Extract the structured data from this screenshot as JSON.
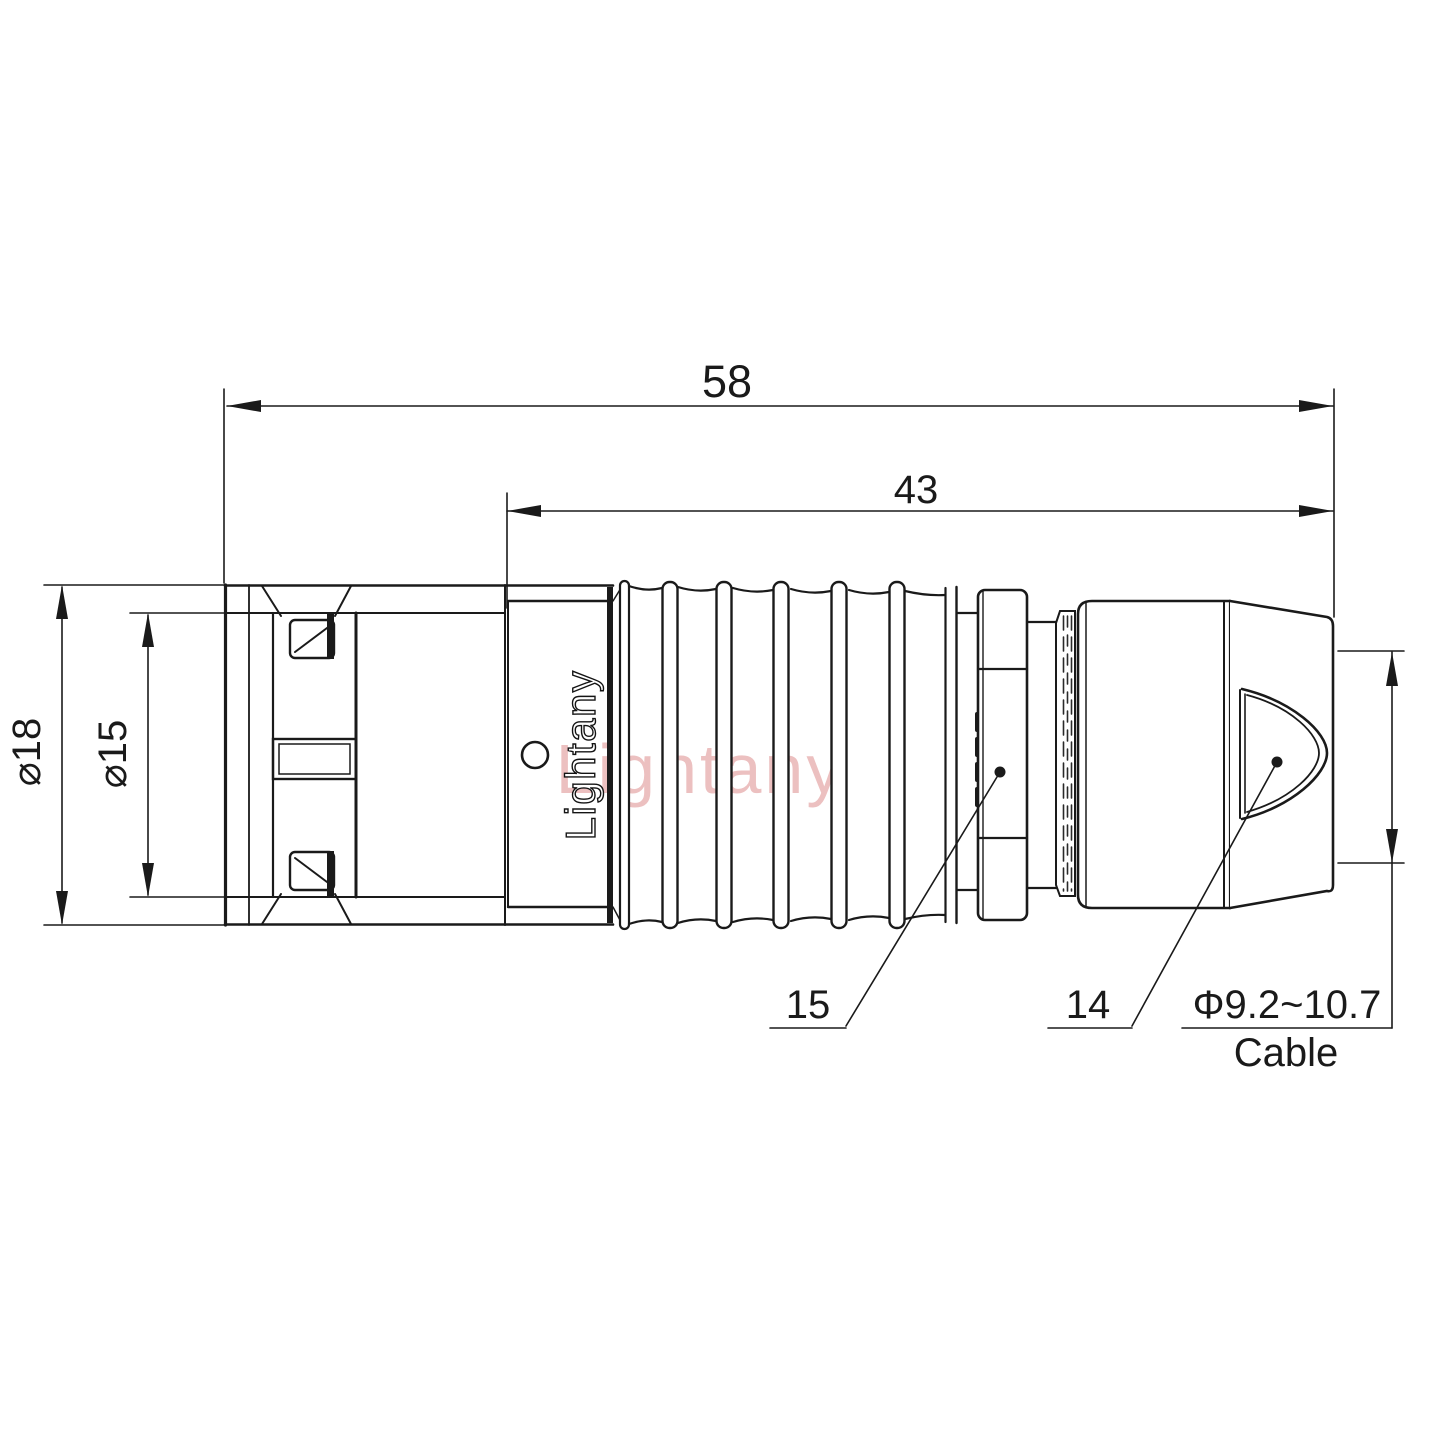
{
  "drawing": {
    "title_watermark": "Lightany",
    "logo": "Lightany",
    "colors": {
      "line": "#1a1a1a",
      "watermark_pink": "#d46a6a",
      "background": "#ffffff"
    },
    "dimensions": {
      "overall_length": "58",
      "rear_length": "43",
      "outer_diameter": "⌀18",
      "inner_diameter": "⌀15",
      "cable_diameter": "Φ9.2~10.7",
      "cable_label": "Cable"
    },
    "callouts": {
      "part_15": "15",
      "part_14": "14"
    }
  }
}
